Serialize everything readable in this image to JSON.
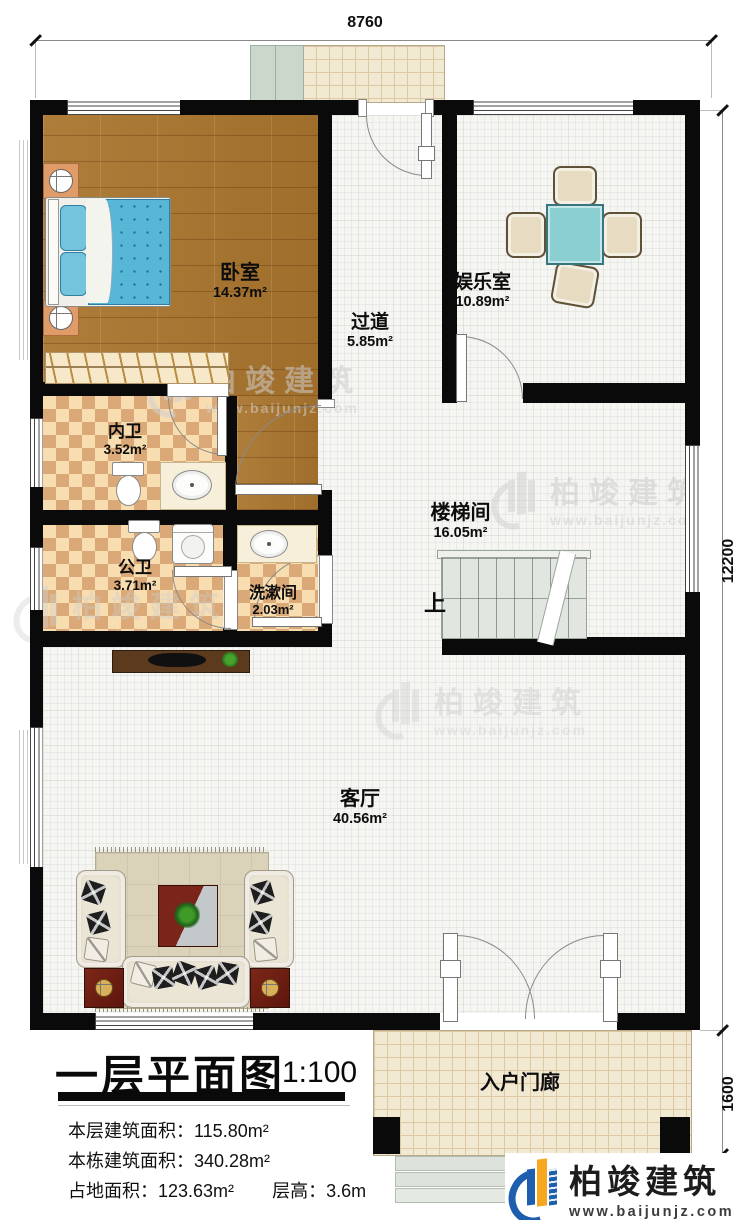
{
  "dims": {
    "top": "8760",
    "right_upper": "12200",
    "right_lower": "1600"
  },
  "rooms": [
    {
      "name": "卧室",
      "area": "14.37m²"
    },
    {
      "name": "过道",
      "area": "5.85m²"
    },
    {
      "name": "娱乐室",
      "area": "10.89m²"
    },
    {
      "name": "内卫",
      "area": "3.52m²"
    },
    {
      "name": "楼梯间",
      "area": "16.05m²"
    },
    {
      "name": "公卫",
      "area": "3.71m²"
    },
    {
      "name": "洗漱间",
      "area": "2.03m²"
    },
    {
      "name": "客厅",
      "area": "40.56m²"
    },
    {
      "name": "入户门廊",
      "area": ""
    }
  ],
  "stairs": {
    "up_label": "上"
  },
  "title_block": {
    "title": "一层平面图",
    "scale": "1:100",
    "line1_label": "本层建筑面积：",
    "line1_value": "115.80m²",
    "line2_label": "本栋建筑面积：",
    "line2_value": "340.28m²",
    "line3_label": "占地面积：",
    "line3_value": "123.63m²",
    "line3b_label": "层高：",
    "line3b_value": "3.6m"
  },
  "branding": {
    "name": "柏竣建筑",
    "url": "www.baijunjz.com",
    "blue": "#1d5fae",
    "orange": "#f7a61f"
  },
  "watermark": {
    "name": "柏竣建筑",
    "url": "www.baijunjz.com"
  }
}
